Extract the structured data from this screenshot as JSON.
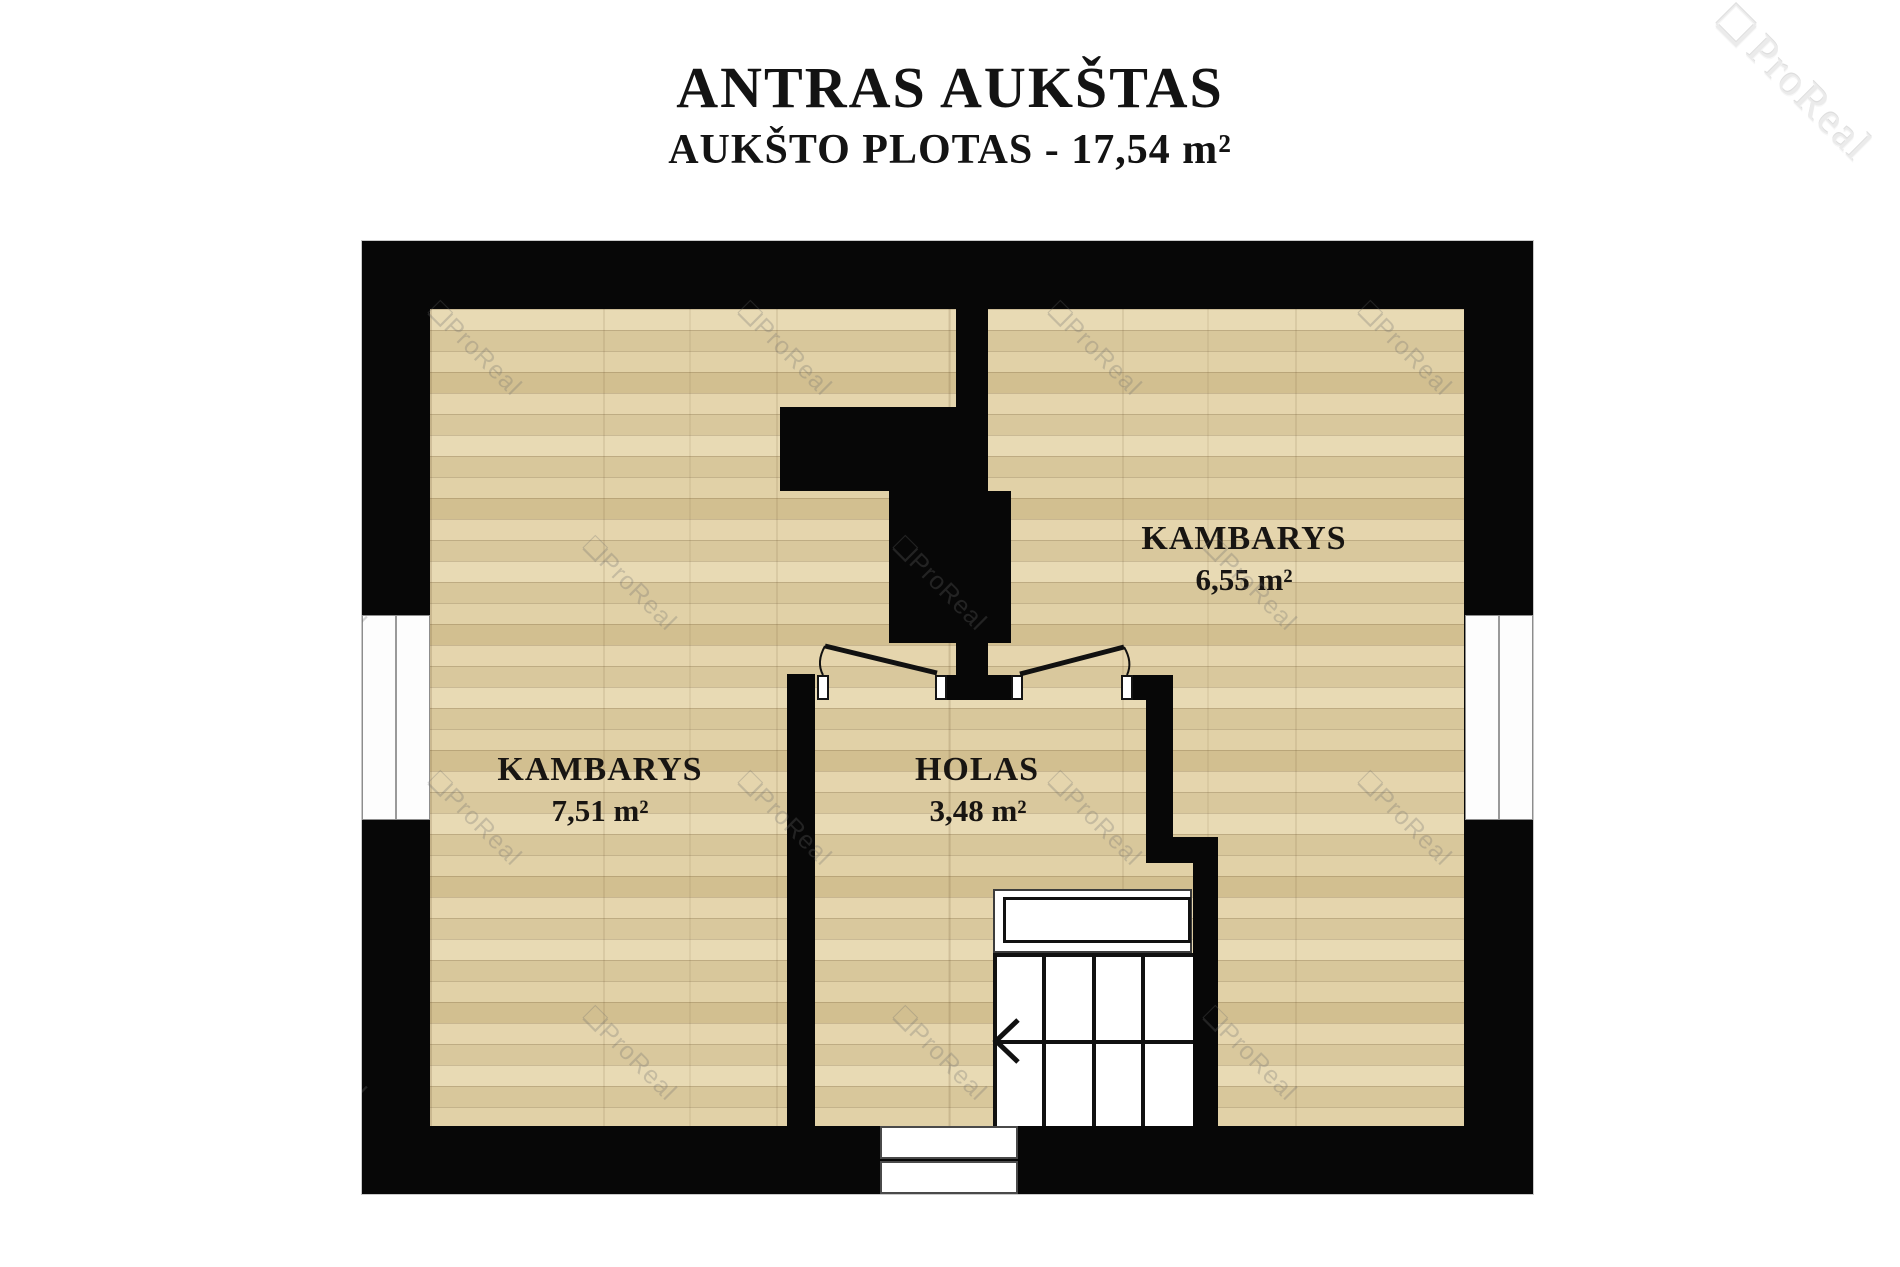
{
  "header": {
    "title": "ANTRAS AUKŠTAS",
    "subtitle": "AUKŠTO PLOTAS - 17,54 m²"
  },
  "rooms": [
    {
      "name": "KAMBARYS",
      "area": "7,51 m²"
    },
    {
      "name": "KAMBARYS",
      "area": "6,55 m²"
    },
    {
      "name": "HOLAS",
      "area": "3,48 m²"
    }
  ],
  "stairs": {
    "direction_arrow": "left"
  },
  "watermark": {
    "text": "ProReal",
    "logo": "❏"
  },
  "colors": {
    "wall": "#070707",
    "floor_base": "#decda2",
    "page": "#ffffff",
    "label_text": "#181512"
  }
}
